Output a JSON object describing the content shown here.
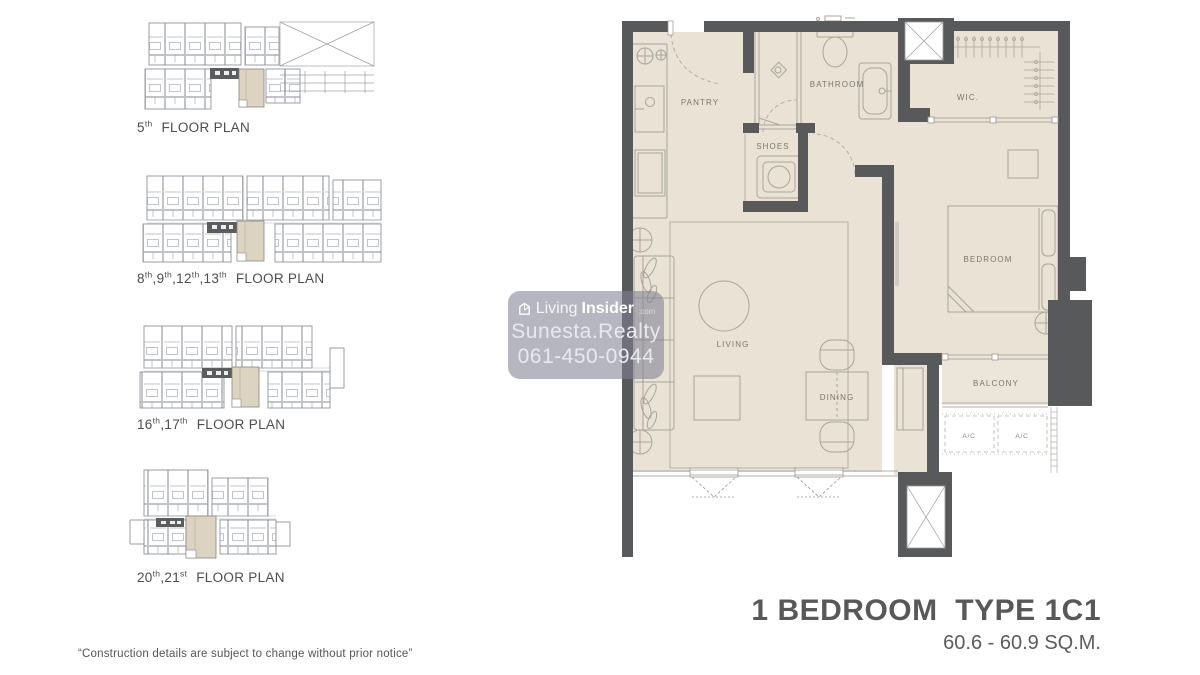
{
  "colors": {
    "wall": "#58595b",
    "floor": "#e9e2d5",
    "floor_light": "#ece6da",
    "highlight_unit": "#dcd4c1",
    "blueprint_line": "#a6a9ae",
    "furniture_line": "#a9a59b",
    "text_dark": "#57585a",
    "watermark_bg": "rgba(128,130,146,0.58)"
  },
  "caption": {
    "sep": ","
  },
  "thumbnails": [
    {
      "floors": [
        {
          "n": "5",
          "s": "th"
        }
      ],
      "label": "FLOOR PLAN"
    },
    {
      "floors": [
        {
          "n": "8",
          "s": "th"
        },
        {
          "n": "9",
          "s": "th"
        },
        {
          "n": "12",
          "s": "th"
        },
        {
          "n": "13",
          "s": "th"
        }
      ],
      "label": "FLOOR PLAN"
    },
    {
      "floors": [
        {
          "n": "16",
          "s": "th"
        },
        {
          "n": "17",
          "s": "th"
        }
      ],
      "label": "FLOOR PLAN"
    },
    {
      "floors": [
        {
          "n": "20",
          "s": "th"
        },
        {
          "n": "21",
          "s": "st"
        }
      ],
      "label": "FLOOR PLAN"
    }
  ],
  "plan": {
    "rooms": {
      "pantry": "PANTRY",
      "bathroom": "BATHROOM",
      "shoes": "SHOES",
      "wic": "WIC.",
      "living": "LIVING",
      "dining": "DINING",
      "bedroom": "BEDROOM",
      "balcony": "BALCONY",
      "ac1": "A/C",
      "ac2": "A/C"
    }
  },
  "watermark": {
    "brand_prefix": "Living",
    "brand_suffix": "Insider",
    "brand_tld": ".com",
    "agency": "Sunesta.Realty",
    "phone": "061-450-0944"
  },
  "title": {
    "name": "1 BEDROOM  TYPE 1C1",
    "area": "60.6 - 60.9 SQ.M."
  },
  "disclaimer": "“Construction details are subject to change without prior notice”"
}
